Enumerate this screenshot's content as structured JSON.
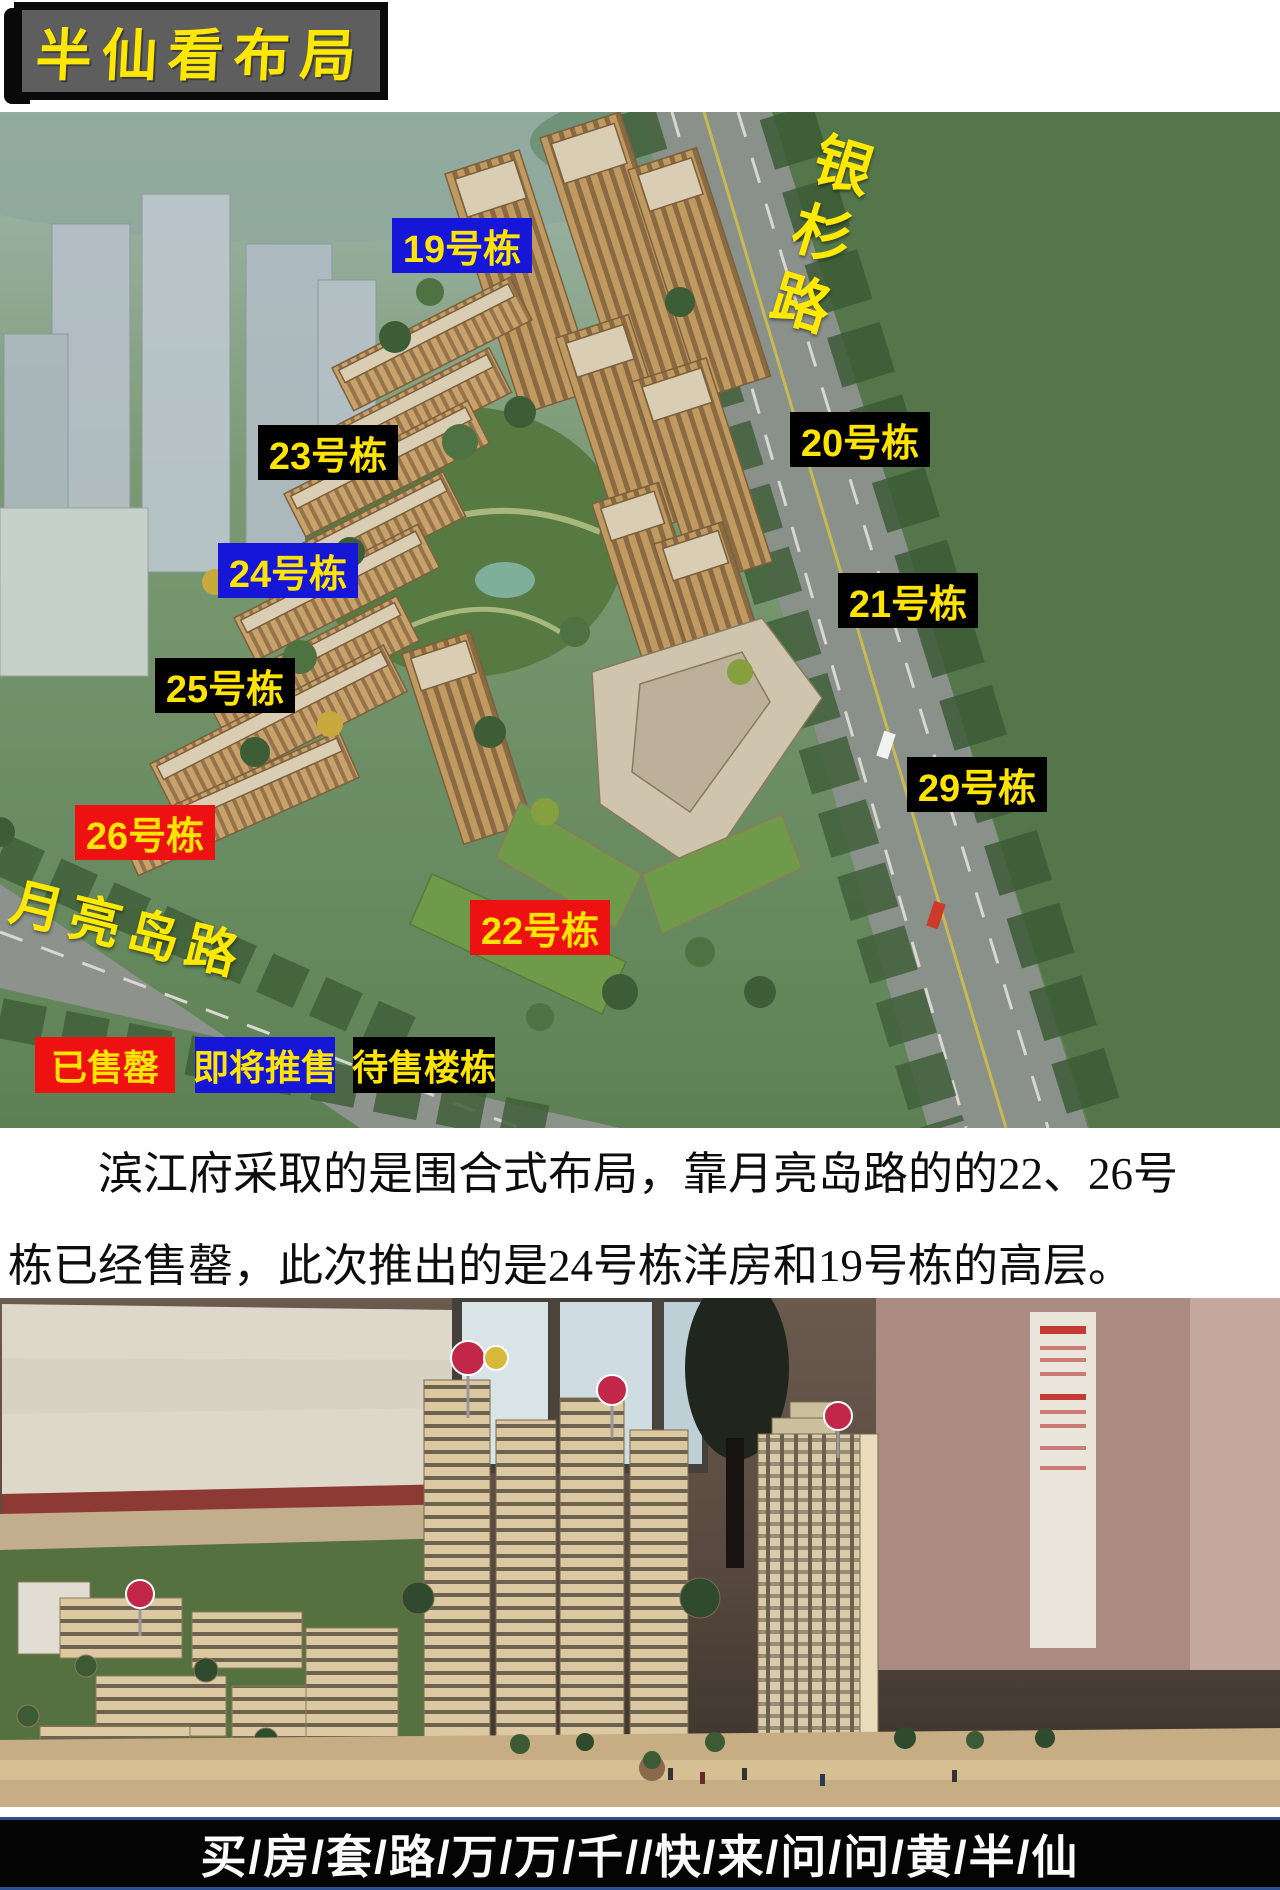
{
  "title": {
    "text": "半仙看布局"
  },
  "site_plan": {
    "road_labels": {
      "vertical": "银杉路",
      "horizontal": "月亮岛路"
    },
    "building_labels": [
      {
        "id": "19",
        "text": "19号栋",
        "status": "upcoming"
      },
      {
        "id": "23",
        "text": "23号栋",
        "status": "for_sale"
      },
      {
        "id": "20",
        "text": "20号栋",
        "status": "for_sale"
      },
      {
        "id": "24",
        "text": "24号栋",
        "status": "upcoming"
      },
      {
        "id": "21",
        "text": "21号栋",
        "status": "for_sale"
      },
      {
        "id": "25",
        "text": "25号栋",
        "status": "for_sale"
      },
      {
        "id": "29",
        "text": "29号栋",
        "status": "for_sale"
      },
      {
        "id": "26",
        "text": "26号栋",
        "status": "sold_out"
      },
      {
        "id": "22",
        "text": "22号栋",
        "status": "sold_out"
      }
    ],
    "legend": [
      {
        "text": "已售罄",
        "status": "sold_out",
        "color": "#ee1111"
      },
      {
        "text": "即将推售",
        "status": "upcoming",
        "color": "#1616d8"
      },
      {
        "text": "待售楼栋",
        "status": "for_sale",
        "color": "#000000"
      }
    ],
    "status_colors": {
      "sold_out": "#ee1111",
      "upcoming": "#1616d8",
      "for_sale": "#000000",
      "label_text": "#ffe400"
    }
  },
  "description": {
    "lines": [
      "滨江府采取的是围合式布局，靠月亮岛路的的22、26号",
      "栋已经售罄，此次推出的是24号栋洋房和19号栋的高层。"
    ]
  },
  "footer": {
    "text": "买/房/套/路/万/万/千//快/来/问/问/黄/半/仙"
  }
}
